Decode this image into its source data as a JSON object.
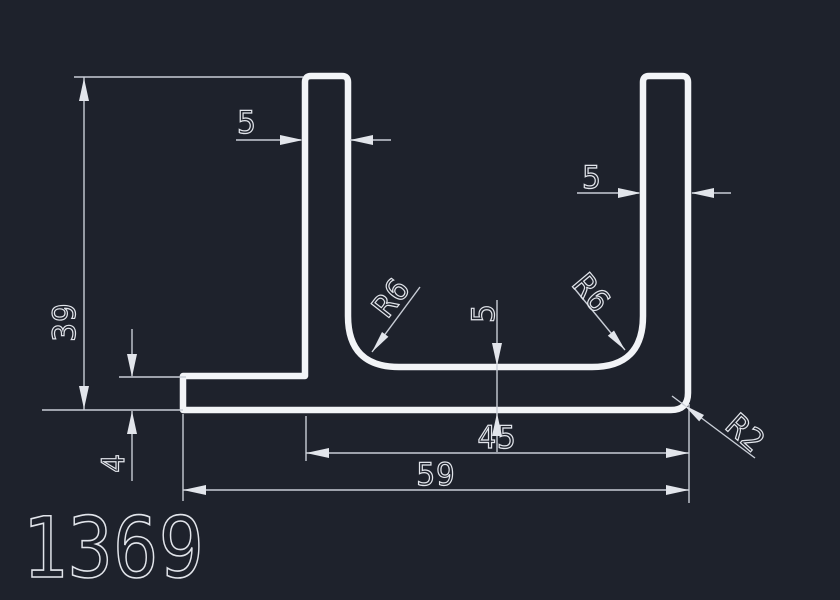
{
  "drawing": {
    "part_number": "1369",
    "dimensions": {
      "overall_height": "39",
      "leg_thickness": "4",
      "left_flange_thickness": "5",
      "right_flange_thickness": "5",
      "base_thickness": "5",
      "channel_width": "45",
      "overall_width": "59",
      "left_inner_fillet": "R6",
      "right_inner_fillet": "R6",
      "outer_corner_radius": "R2"
    },
    "colors": {
      "background": "#1e222c",
      "profile_line": "#f2f4f7",
      "dimension_line": "#c8cdd6",
      "dimension_text": "#e2e5eb"
    }
  }
}
